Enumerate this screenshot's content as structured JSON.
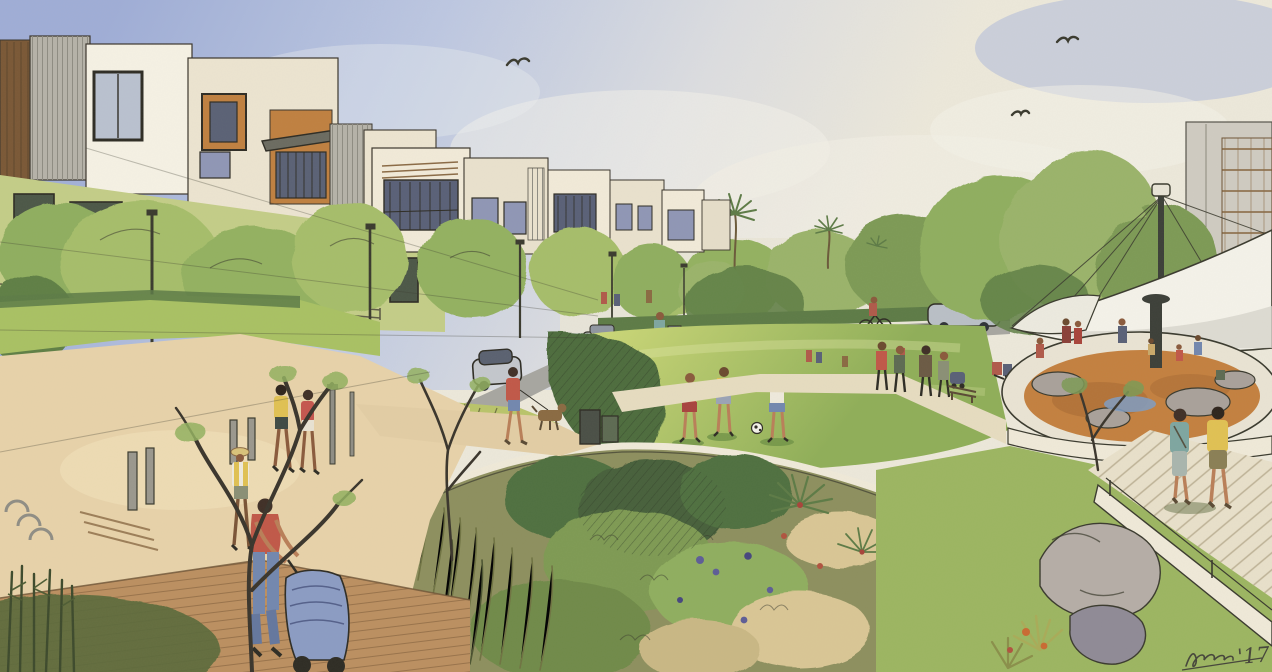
{
  "scene": {
    "type": "watercolor architectural rendering",
    "subject": "residential paseo and neighborhood park concept",
    "signature_year": "'17",
    "sky": [
      "soft blue-violet wash",
      "warm pale horizon",
      "three soaring birds"
    ],
    "buildings": [
      "left cluster of 3-4 story contemporary townhomes, cream stucco with brown and orange accent panels, gray slat siding",
      "receding row of townhomes with balconies, awnings and violet-glass windows",
      "tall sketched apartment block with brown balcony lattice at far right",
      "pale distant buildings at horizon"
    ],
    "park_features": [
      "white tensile fabric shade sail on mast with guy cables",
      "circular playground with orange resilient surface, boulders and water spot",
      "white seat wall with handrail",
      "bioswale rain garden with olive grasses, shrubs, palms and purple flowers",
      "central lawn mound",
      "tan promenade with wood boardwalk",
      "red pergola in distance",
      "palm trees",
      "street trees and light poles",
      "benches, bollards, bike racks, trash bin"
    ],
    "figures": [
      "woman in coral shirt pushing blue stroller",
      "walker in straw hat with yellow vest",
      "two women walking (yellow tank, red top)",
      "person in red shirt walking brown dog",
      "distant dog walker",
      "three children playing soccer on lawn",
      "teal pedestrian and cyclist crossing street",
      "couple with stroller on park path",
      "couple walking to playground (teal top, yellow shirt)",
      "children on playground",
      "seated couple on lawn"
    ],
    "vehicles": [
      "silver car approaching on left street",
      "silver SUV on cross street",
      "silver sedan at right",
      "bicycle"
    ]
  },
  "palette": {
    "skyTop": "#9fadd6",
    "skyMid": "#c3cde3",
    "horizon": "#e9e5d6",
    "cloud": "#f3f2ea",
    "cream": "#ece4d0",
    "white": "#f5f1e4",
    "brown": "#7a5836",
    "orange": "#bf8040",
    "slat": "#b5b2a8",
    "lime": "#c3cd87",
    "glassViolet": "#8f96b5",
    "glassDark": "#4c5747",
    "road": "#a7a6a0",
    "pathTan": "#e7d2a9",
    "walkLight": "#e8e0ca",
    "boardwalk": "#bb8f60",
    "canopy": "#f4f2e9",
    "canopyShade": "#d7d5cc",
    "playOrange": "#c3803f",
    "rock": "#a9a19a",
    "water": "#7f9cc2",
    "grassBright": "#c8d573",
    "grassMid": "#a9c163",
    "lawnRight": "#9cb561",
    "shrubDark": "#4d6c3e",
    "foliageLight": "#a6bd6b",
    "foliageMid": "#93b161",
    "foliageDeep": "#5f7f45",
    "olive": "#8d8f5e",
    "sand": "#d9c695",
    "ink": "#3a3a2e",
    "shirtCoral": "#c05848",
    "shirtYellow": "#e0c153",
    "shirtTeal": "#7ea6a0",
    "jeans": "#7287ae",
    "strollerBlue": "#8b9cc3",
    "seatWall": "#efe9d8",
    "skin": "#b97f58"
  }
}
